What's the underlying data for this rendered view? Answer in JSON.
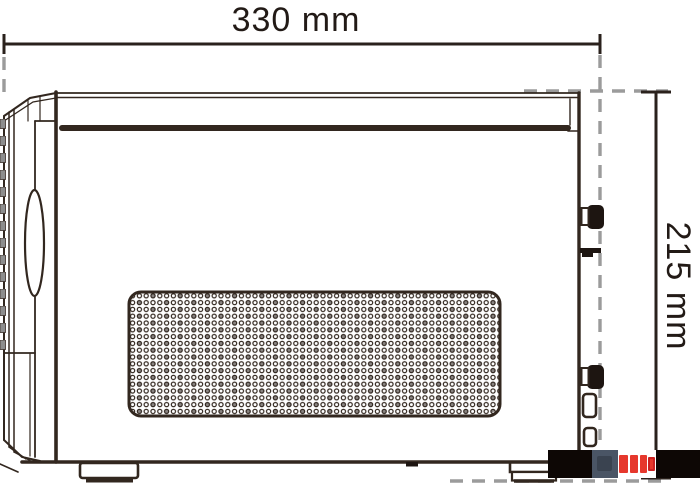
{
  "drawing": {
    "subject": "pc-case-side-view-technical-drawing",
    "annotations": {
      "width_label": "330 mm",
      "height_label": "215 mm"
    },
    "colors": {
      "line": "#32271f",
      "label_text": "#221a16",
      "extension_dash_gray": "#9b9b9b",
      "vent_slat_gray": "#8d8d8d",
      "background": "#ffffff"
    }
  },
  "watermark": {
    "colors": {
      "black": "#0d0705",
      "slate": "#4a5565",
      "red": "#e6382d"
    }
  }
}
